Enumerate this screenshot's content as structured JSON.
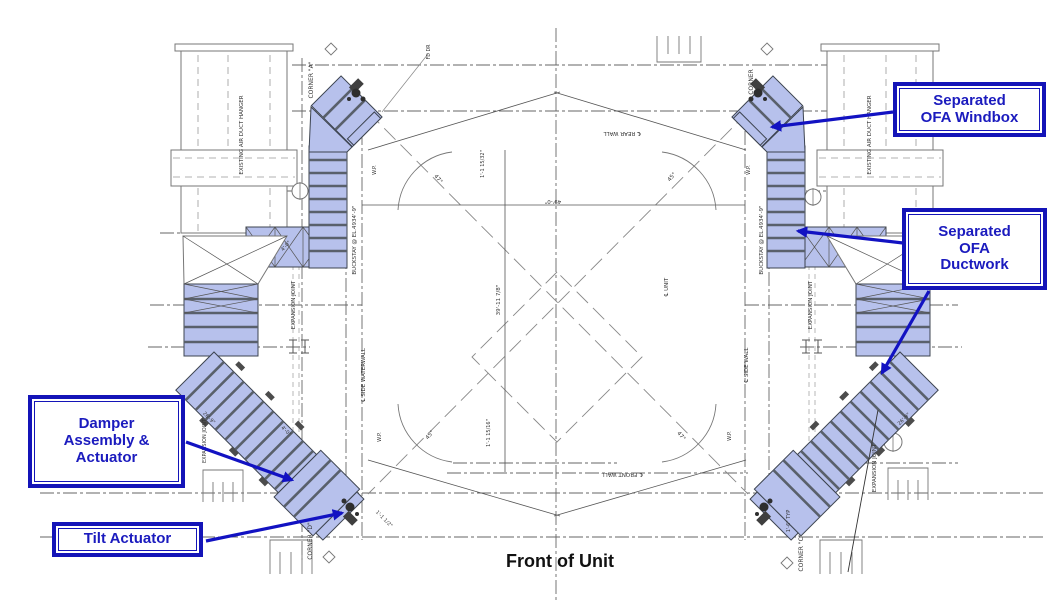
{
  "callouts": {
    "windbox": {
      "line1": "Separated",
      "line2": "OFA Windbox"
    },
    "ductwork": {
      "line1": "Separated",
      "line2": "OFA",
      "line3": "Ductwork"
    },
    "damper": {
      "line1": "Damper",
      "line2": "Assembly &",
      "line3": "Actuator"
    },
    "tilt": {
      "line1": "Tilt Actuator"
    }
  },
  "caption": "Front of Unit",
  "labels": {
    "existing_hanger": "EXISTING AIR DUCT HANGER",
    "corner_a": "CORNER \"A\"",
    "corner_b": "CORNER",
    "corner_c": "CORNER \"C\"",
    "corner_d": "CORNER \"D\"",
    "buckstay": "BUCKSTAY @ EL.4934'-9\"",
    "expansion_joint": "EXPANSION JOINT",
    "side_waterwall": "℄ SIDE WATERWALL",
    "side_wall": "℄ SIDE WALL",
    "unit_cl": "℄ UNIT",
    "front_wall": "℄ FRONT WALL",
    "rear_wall": "℄ REAR WALL",
    "wp": "W.P.",
    "fd_dr": "FD DR",
    "dim_49": "49'-0\"",
    "dim_39": "39'-11 7/8\"",
    "dim_frac_top": "1'-1 15/32\"",
    "dim_frac_bottom": "1'-1 15/16\"",
    "dim_1_1_half": "1'-1 1/2\"",
    "dim_4_0": "4'-0\"",
    "dim_26_9": "26'-9\"",
    "dim_1_6_typ": "1'-6\" TYP",
    "angle_47": "47°",
    "angle_45": "45°"
  },
  "colors": {
    "callout_border_blue": "#1414b8",
    "callout_text_blue": "#1b1bbe",
    "arrow_blue": "#1212c2",
    "duct_fill_blue": "#b7c1ec",
    "drawing_line_gray": "#666666",
    "caption_black": "#111111"
  }
}
